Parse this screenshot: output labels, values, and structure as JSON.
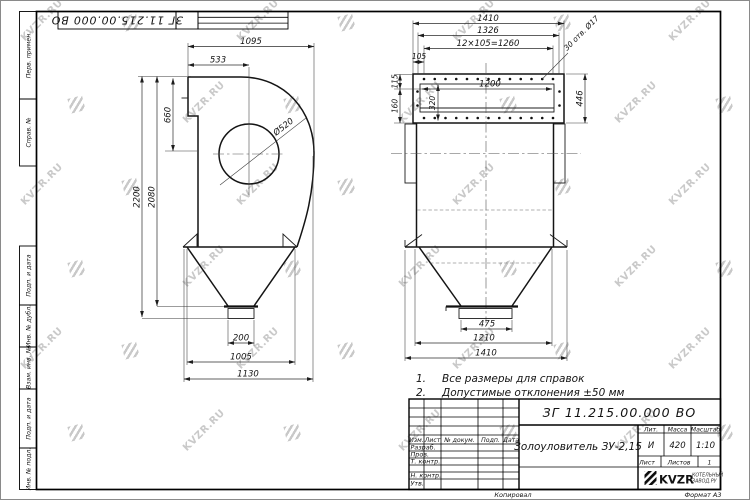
{
  "watermark": {
    "text": "KVZR.RU"
  },
  "sheet": {
    "margin_labels": {
      "perv_primen": "Перв. примен.",
      "sprav_no": "Справ. №",
      "podp_i_data_1": "Подп. и дата",
      "inv_no_dubl": "Инв. № дубл.",
      "vzam_inv_no": "Взам. инв. №",
      "podp_i_data_2": "Подп. и дата",
      "inv_no_podl": "Инв. № подл."
    },
    "kopiroval": "Копировал",
    "format": "Формат А3"
  },
  "drawing": {
    "left_view": {
      "dims": {
        "w1095": "1095",
        "w533": "533",
        "h660": "660",
        "dia520": "Ø520",
        "h2200": "2200",
        "h2080": "2080",
        "w200": "200",
        "w1005": "1005",
        "w1130": "1130"
      }
    },
    "right_view": {
      "dims": {
        "w1410_top": "1410",
        "w1326": "1326",
        "holes_pitch": "12×105=1260",
        "w105": "105",
        "holes_note": "30 отв. Ø17",
        "h115": "115",
        "h160": "160",
        "h320": "320",
        "w1200": "1200",
        "h446": "446",
        "w475": "475",
        "w1210": "1210",
        "w1410_bottom": "1410"
      }
    }
  },
  "notes": {
    "n1_num": "1.",
    "n1_text": "Все размеры для справок",
    "n2_num": "2.",
    "n2_text": "Допустимые отклонения ±50 мм"
  },
  "title_block": {
    "doc_number": "ЗГ 11.215.00.000 ВО",
    "product_name": "Золоуловитель ЗУ-2,15",
    "col_izm": "Изм.",
    "col_list": "Лист",
    "col_n_dokum": "№ докум.",
    "col_podp": "Подп.",
    "col_data": "Дата",
    "row_razrab": "Разраб.",
    "row_prov": "Пров.",
    "row_t_kontr": "Т. контр.",
    "row_n_kontr": "Н. контр.",
    "row_utv": "Утв.",
    "lit_header": "Лит.",
    "massa_header": "Масса",
    "masshtab_header": "Масштаб",
    "lit_value": "И",
    "massa_value": "420",
    "masshtab_value": "1:10",
    "list_label": "Лист",
    "listov_label": "Листов",
    "listov_value": "1",
    "logo_text": "KVZR",
    "logo_sub1": "КОТЕЛЬНЫЙ",
    "logo_sub2": "ЗАВОД.РУ"
  }
}
